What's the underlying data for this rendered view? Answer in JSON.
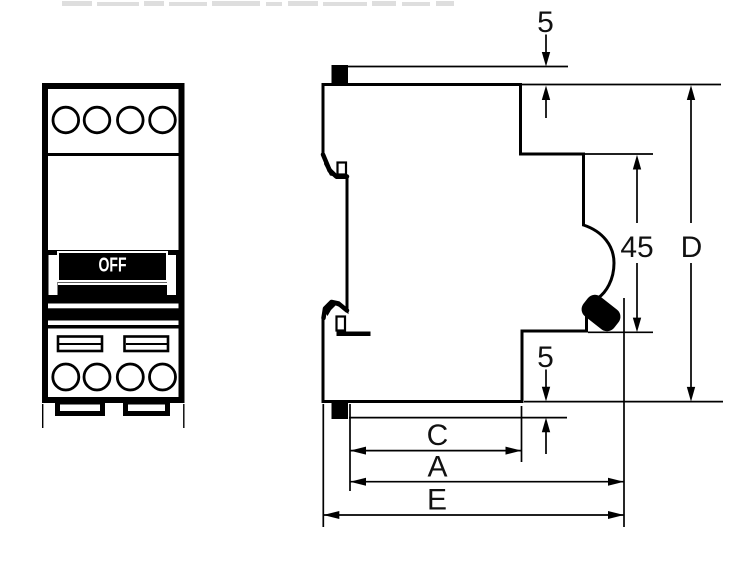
{
  "drawing": {
    "background": "#ffffff",
    "line_color": "#000000",
    "description": "Two-view outline drawing of a DIN-rail miniature circuit breaker: front view at left, side profile with dimension callouts at right"
  },
  "front_view": {
    "switch_label": "OFF",
    "top_terminal_ports": 4,
    "bottom_terminal_ports": 4,
    "terminal_screw_slots": 2,
    "mounting_feet": 2
  },
  "dimensions": {
    "top_tab": {
      "label": "5"
    },
    "front_face": {
      "label": "45"
    },
    "overall_height": {
      "label": "D"
    },
    "bottom_tab": {
      "label": "5"
    },
    "base_depth": {
      "label": "C"
    },
    "depth_with_toggle": {
      "label": "A"
    },
    "overall_depth": {
      "label": "E"
    }
  }
}
